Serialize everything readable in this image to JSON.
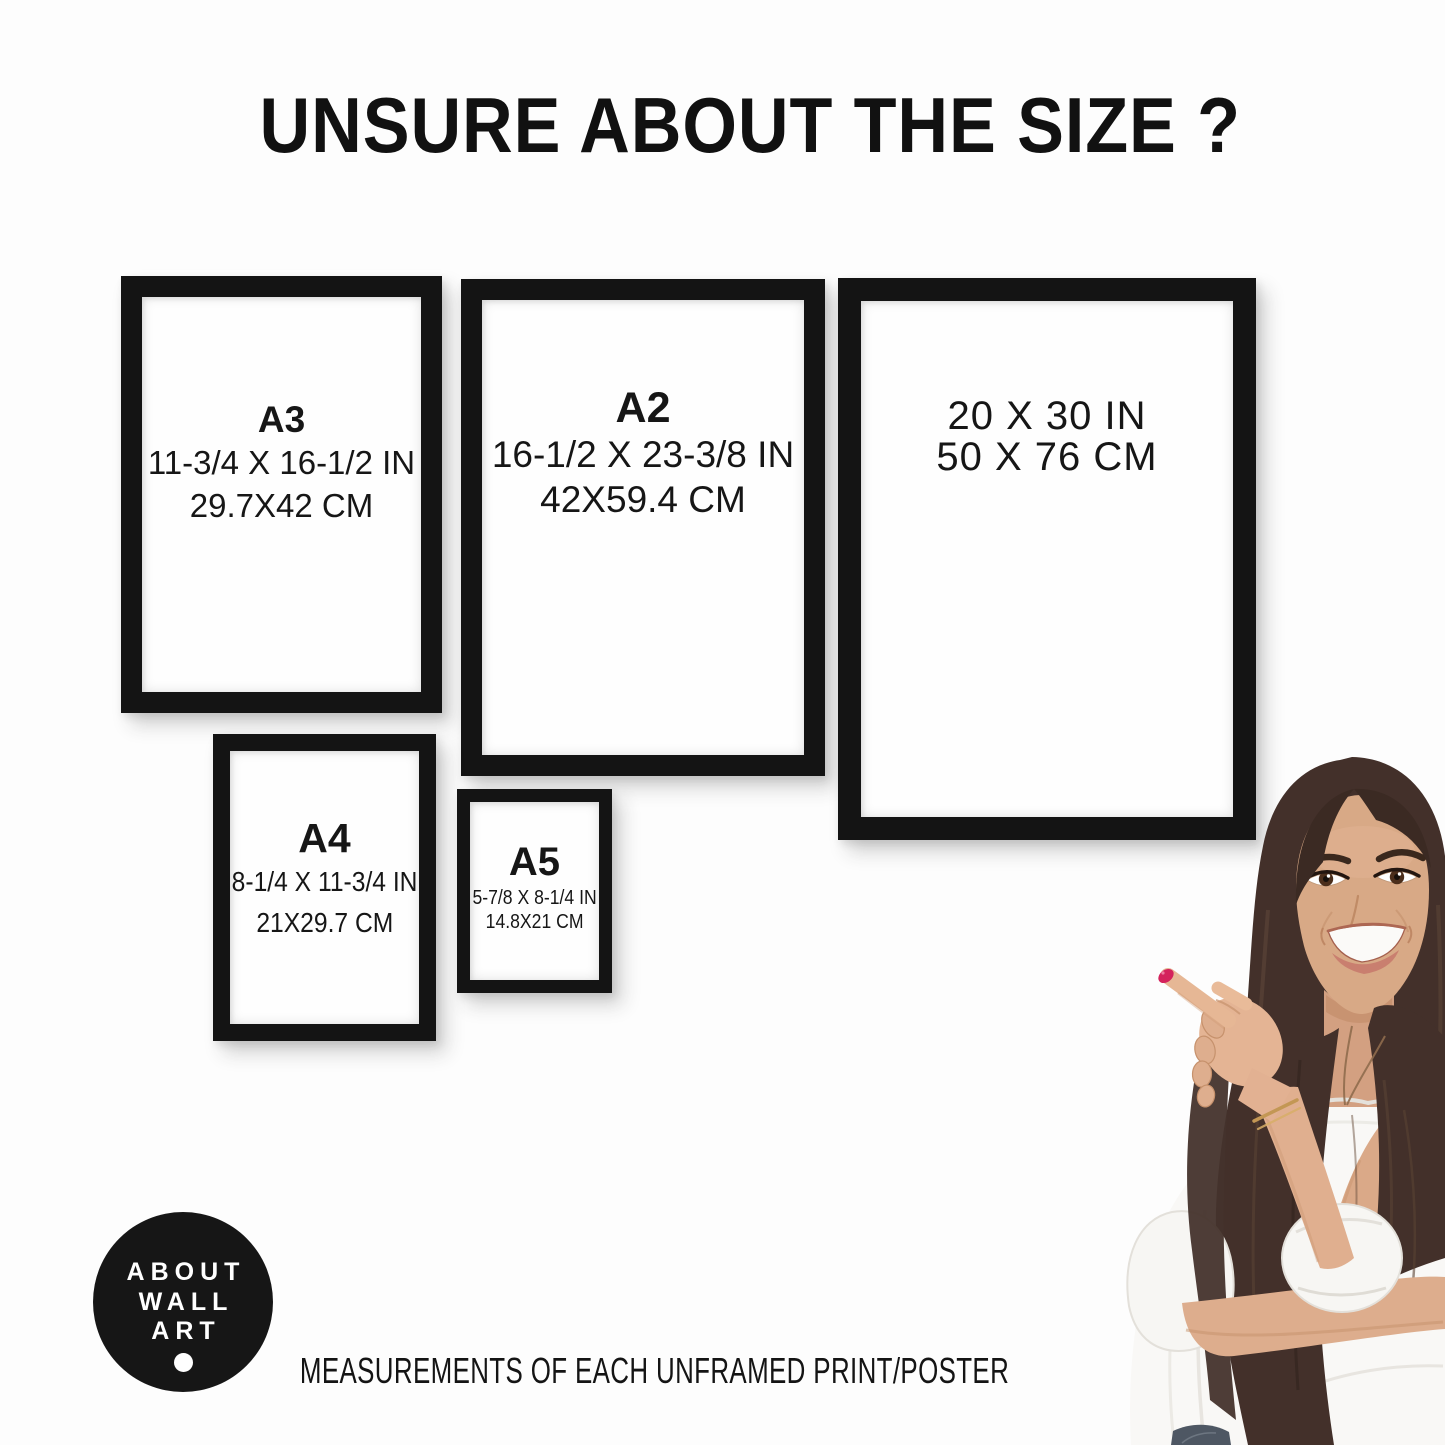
{
  "page": {
    "title": "UNSURE ABOUT THE SIZE ?",
    "footer": "MEASUREMENTS OF EACH UNFRAMED PRINT/POSTER"
  },
  "frames": [
    {
      "label": "A3",
      "inches": "11-3/4 X 16-1/2 IN",
      "cm": "29.7X42 CM"
    },
    {
      "label": "A2",
      "inches": "16-1/2 X 23-3/8 IN",
      "cm": "42X59.4 CM"
    },
    {
      "inches": "20 X 30 IN",
      "cm": "50 X 76 CM"
    },
    {
      "label": "A4",
      "inches": "8-1/4 X 11-3/4 IN",
      "cm": "21X29.7 CM"
    },
    {
      "label": "A5",
      "inches": "5-7/8 X 8-1/4 IN",
      "cm": "14.8X21 CM"
    }
  ],
  "logo": {
    "lines": [
      "ABOUT",
      "WALL",
      "ART"
    ]
  },
  "illustration": {
    "description": "smiling woman with long brown hair pointing at the frames"
  },
  "colors": {
    "frame": "#141414",
    "text": "#1a1a1a",
    "logo_bg": "#161616",
    "hair": "#43302a",
    "skin": "#d8a986",
    "blouse": "#f9f8f6",
    "nail": "#d4225c",
    "jeans": "#4e5763"
  }
}
